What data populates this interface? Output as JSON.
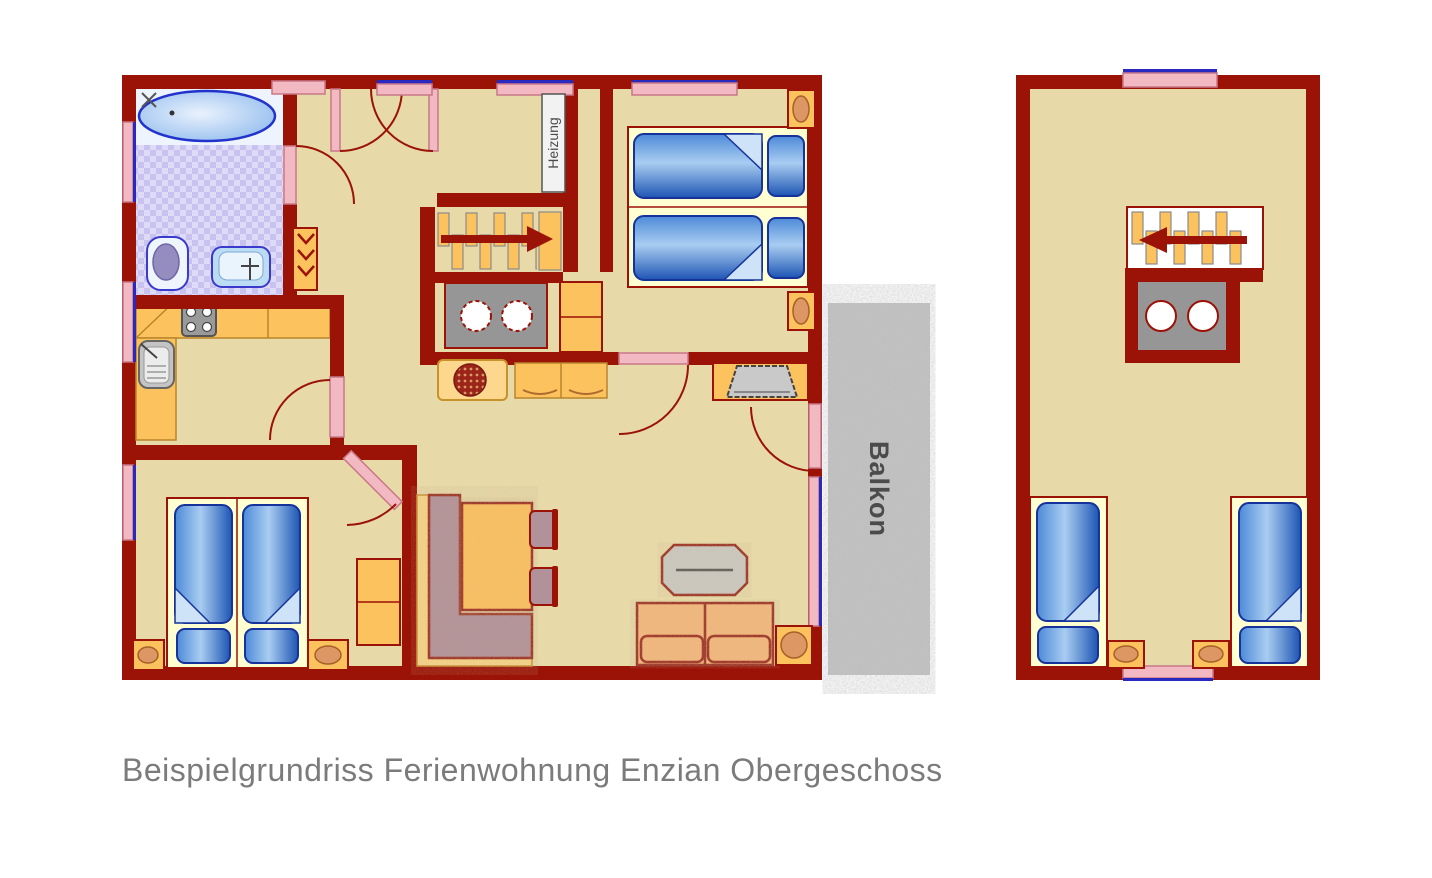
{
  "labels": {
    "heizung": "Heizung",
    "balkon": "Balkon"
  },
  "caption": "Beispielgrundriss Ferienwohnung Enzian Obergeschoss",
  "palette": {
    "wall": "#9b1206",
    "floor": "#e7d9a8",
    "orange": "#fcc25e",
    "orange_line": "#b8862a",
    "oval": "#dc9765",
    "pink": "#f3b9c3",
    "pink_line": "#c87888",
    "window_blue": "#2929c0",
    "bed_light": "#a9cdf1",
    "bed_mid": "#4d8ad8",
    "bed_dark": "#1e55b4",
    "bed_border": "#16339b",
    "frame_bg": "#ffffd2",
    "tile": "#c7c2ee",
    "tile_alt": "#dedaf7",
    "gray": "#969696",
    "light_gray": "#cbcac2",
    "balcony": "#c3c3c3",
    "mauve": "#b2929a",
    "sofa": "#f4b97e",
    "caption_color": "#7b7b7b",
    "label_color": "#4b4b4b"
  }
}
